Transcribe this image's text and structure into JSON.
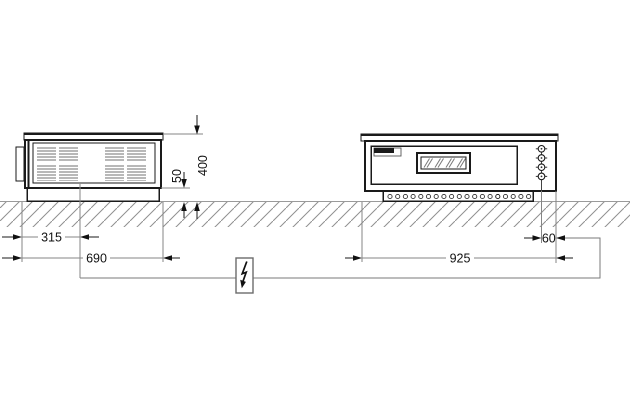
{
  "drawing": {
    "kind": "appliance-installation-dimension-drawing",
    "views": {
      "side_view": "left",
      "front_view": "right"
    }
  },
  "dimensions_mm": {
    "side_view": {
      "connection_offset_from_left": "315",
      "total_depth": "690",
      "base_height": "50",
      "total_height": "400"
    },
    "front_view": {
      "total_width": "925",
      "connection_offset_from_right": "60"
    }
  },
  "symbols": {
    "electrical_connection": "lightning-bolt-icon"
  },
  "colors": {
    "drawing_line": "#1a1a1a",
    "dimension_line": "#808080",
    "ground_hatch": "#8f8f8f",
    "label_text": "#111111",
    "background": "#ffffff"
  }
}
